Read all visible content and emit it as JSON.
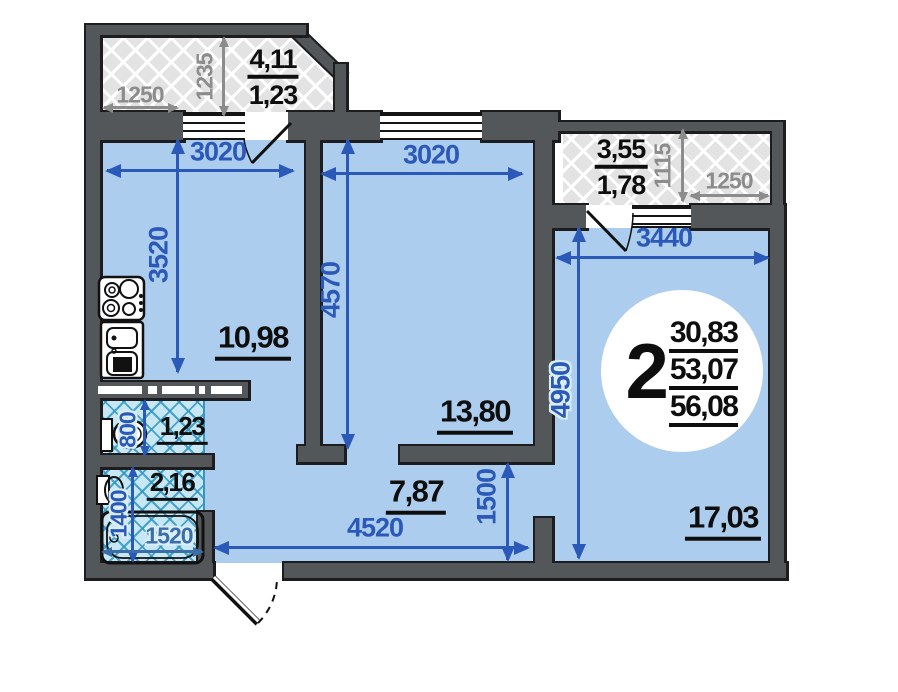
{
  "apartment_summary": {
    "rooms": "2",
    "living_area": "30,83",
    "area_without_balconies": "53,07",
    "total_area": "56,08"
  },
  "rooms": {
    "kitchen": {
      "area": "10,98",
      "width_mm": "3020",
      "depth_mm": "3520"
    },
    "living_room": {
      "area": "13,80",
      "width_mm": "3020",
      "depth_mm": "4570"
    },
    "bedroom": {
      "area": "17,03",
      "width_mm": "3440",
      "depth_mm": "4950"
    },
    "hallway": {
      "area": "7,87",
      "width_mm": "4520",
      "depth_mm": "1500"
    },
    "wc": {
      "area": "1,23",
      "width_mm": "800"
    },
    "bathroom": {
      "area": "2,16",
      "depth_mm": "1400",
      "bathtub_mm": "1520"
    },
    "balcony_left": {
      "area_full": "4,11",
      "area_reduced": "1,23",
      "width_mm": "1250",
      "depth_mm": "1235"
    },
    "balcony_right": {
      "area_full": "3,55",
      "area_reduced": "1,78",
      "width_mm": "1250",
      "depth_mm": "1115"
    }
  },
  "colors": {
    "wall": "#54575a",
    "wall_outline": "#1d1d1f",
    "room_fill": "#adcdee",
    "wet_room_fill": "#c8e7f4",
    "wet_room_line": "#3595bd",
    "balcony_fill": "#e3e3e3",
    "dimension_blue": "#2b59b8",
    "dimension_gray": "#8c8c8c",
    "label_black": "#0e0e0e"
  }
}
